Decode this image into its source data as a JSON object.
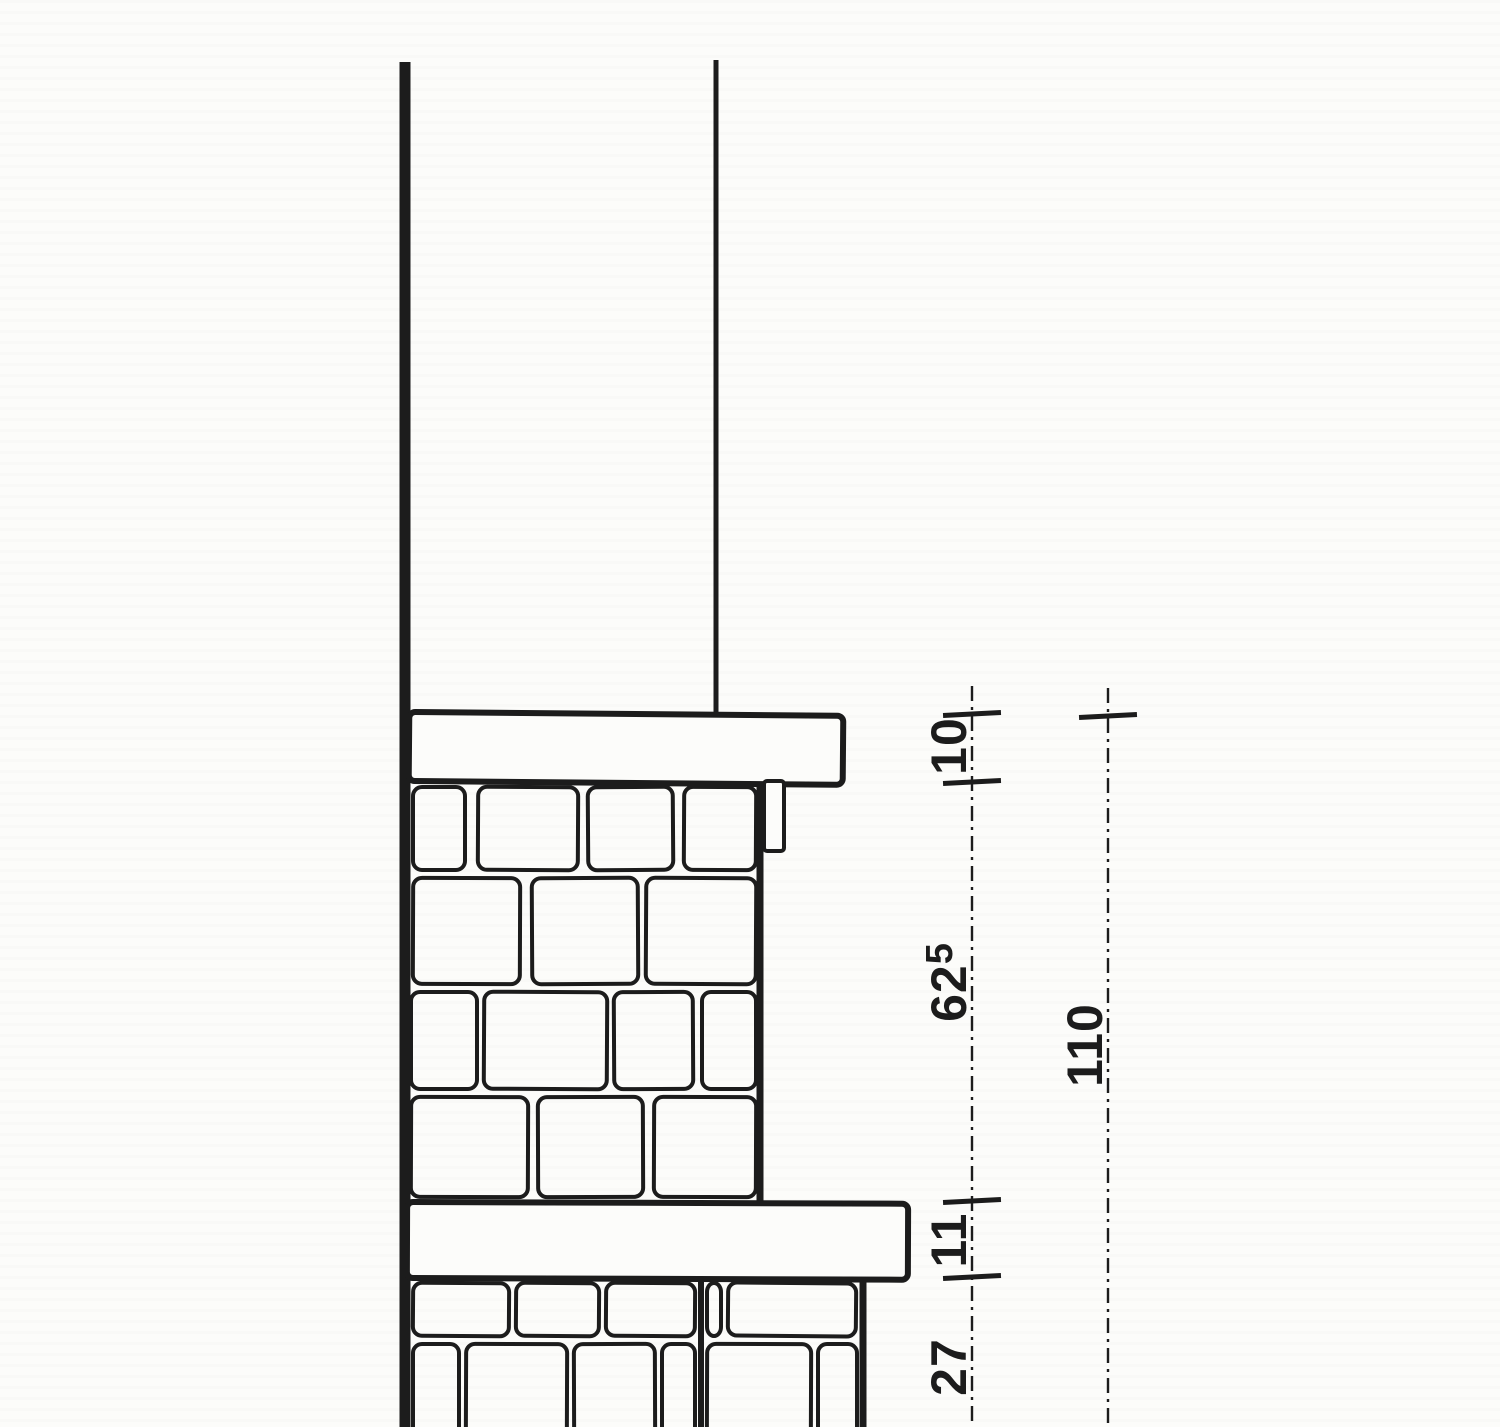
{
  "figure": {
    "kind": "architectural-wall-section-detail",
    "paper_color": "#fcfcfa",
    "ink_color": "#1c1c1c"
  },
  "canvas": {
    "width": 1500,
    "height": 1427
  },
  "drawing": {
    "lines": [
      {
        "name": "wall-back-face-line",
        "x": 405,
        "y1": 62,
        "y2": 1427,
        "w": 11
      },
      {
        "name": "upper-wall-face-line",
        "x": 716,
        "y1": 60,
        "y2": 716,
        "w": 5
      },
      {
        "name": "upper-masonry-face-line",
        "x": 760,
        "y1": 782,
        "y2": 1204,
        "w": 7
      },
      {
        "name": "lower-masonry-face-line",
        "x": 863,
        "y1": 1279,
        "y2": 1427,
        "w": 7
      },
      {
        "name": "masonry-heavy-joint-line",
        "x": 701,
        "y1": 1280,
        "y2": 1427,
        "w": 6
      }
    ],
    "slabs": [
      {
        "name": "coping-slab",
        "x": 409,
        "y": 712,
        "w": 434,
        "h": 69,
        "stroke": 6,
        "tilt": 0.5,
        "r": 6
      },
      {
        "name": "string-course-slab",
        "x": 407,
        "y": 1202,
        "w": 501,
        "h": 76,
        "stroke": 6,
        "tilt": 0.2,
        "r": 6
      }
    ],
    "drip": {
      "name": "drip-fillet",
      "x": 764,
      "y": 781,
      "w": 20,
      "h": 70,
      "stroke": 4,
      "r": 3
    },
    "stones": {
      "stroke": 4,
      "radius": 9,
      "blocks": [
        [
          413,
          787,
          52,
          83,
          0
        ],
        [
          478,
          787,
          100,
          83,
          0.3
        ],
        [
          588,
          787,
          85,
          83,
          -0.4
        ],
        [
          684,
          787,
          72,
          83,
          0.3
        ],
        [
          413,
          878,
          107,
          106,
          0.2
        ],
        [
          532,
          878,
          106,
          106,
          -0.3
        ],
        [
          646,
          878,
          110,
          106,
          0.3
        ],
        [
          411,
          992,
          66,
          97,
          0
        ],
        [
          484,
          992,
          123,
          97,
          0.3
        ],
        [
          614,
          992,
          79,
          97,
          -0.3
        ],
        [
          702,
          992,
          54,
          97,
          0
        ],
        [
          411,
          1097,
          117,
          100,
          0.2
        ],
        [
          538,
          1097,
          105,
          100,
          -0.2
        ],
        [
          654,
          1097,
          102,
          100,
          0.2
        ],
        [
          413,
          1283,
          96,
          53,
          0.4
        ],
        [
          516,
          1283,
          83,
          53,
          0.4
        ],
        [
          606,
          1283,
          89,
          53,
          0.4
        ],
        [
          707,
          1283,
          14,
          53,
          0
        ],
        [
          728,
          1283,
          128,
          53,
          0.5
        ],
        [
          413,
          1344,
          46,
          95,
          0
        ],
        [
          466,
          1344,
          101,
          95,
          0.2
        ],
        [
          574,
          1344,
          81,
          95,
          -0.2
        ],
        [
          662,
          1344,
          33,
          95,
          0
        ],
        [
          707,
          1344,
          104,
          95,
          0.2
        ],
        [
          818,
          1344,
          39,
          95,
          0
        ]
      ]
    }
  },
  "dimensions": {
    "font_size": 50,
    "sup_font_size": 38,
    "sup_shift": -14,
    "tick": {
      "len": 58,
      "stroke": 5,
      "angle": -3
    },
    "line_style": {
      "stroke": 2.4,
      "dash": "15 6 3 6"
    },
    "chains": [
      {
        "name": "segment-dimension-line",
        "x": 972,
        "y1": 686,
        "y2": 1427,
        "ticks": [
          714,
          782,
          1201,
          1277
        ],
        "labels": [
          {
            "text": "10",
            "sup": "",
            "x": 966,
            "y": 746
          },
          {
            "text": "62",
            "sup": "5",
            "x": 966,
            "y": 982
          },
          {
            "text": "11",
            "sup": "",
            "x": 966,
            "y": 1240
          },
          {
            "text": "27",
            "sup": "",
            "x": 966,
            "y": 1367
          }
        ]
      },
      {
        "name": "overall-dimension-line",
        "x": 1108,
        "y1": 688,
        "y2": 1427,
        "ticks": [
          716
        ],
        "labels": [
          {
            "text": "110",
            "sup": "",
            "x": 1102,
            "y": 1045
          }
        ]
      }
    ]
  }
}
